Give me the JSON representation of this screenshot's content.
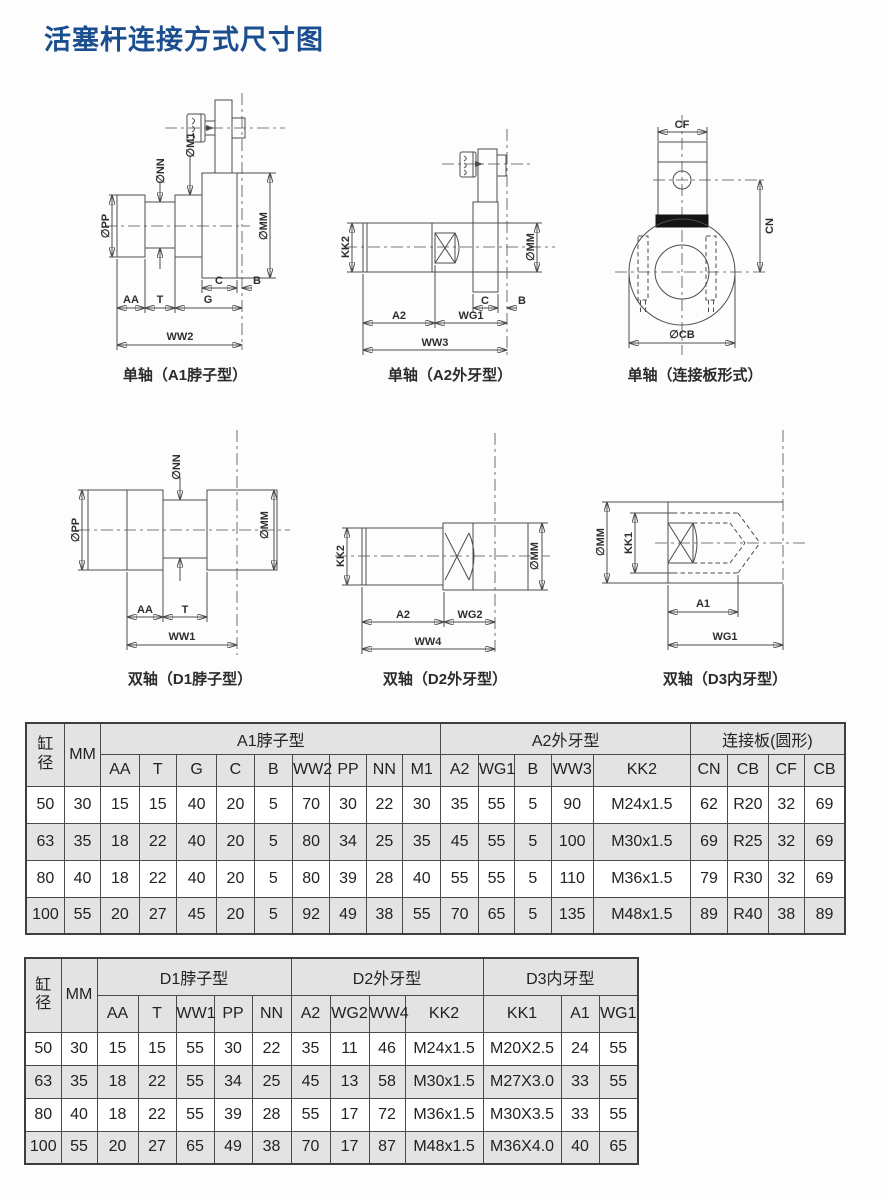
{
  "page": {
    "title": "活塞杆连接方式尺寸图"
  },
  "colors": {
    "title": "#1b4e8e",
    "stripe": "#e3e3e3",
    "line": "#4d4d4d"
  },
  "diagrams": {
    "a1": {
      "caption": "单轴（A1脖子型）",
      "pp": "∅PP",
      "nn": "∅NN",
      "m1": "∅M1",
      "mm": "∅MM",
      "c": "C",
      "b": "B",
      "aa": "AA",
      "t": "T",
      "g": "G",
      "ww2": "WW2"
    },
    "a2": {
      "caption": "单轴（A2外牙型）",
      "kk2": "KK2",
      "mm": "∅MM",
      "c": "C",
      "b": "B",
      "a2": "A2",
      "wg1": "WG1",
      "ww3": "WW3"
    },
    "plate": {
      "caption": "单轴（连接板形式）",
      "cf": "CF",
      "cn": "CN",
      "cb": "∅CB"
    },
    "d1": {
      "caption": "双轴（D1脖子型）",
      "pp": "∅PP",
      "nn": "∅NN",
      "mm": "∅MM",
      "aa": "AA",
      "t": "T",
      "ww1": "WW1"
    },
    "d2": {
      "caption": "双轴（D2外牙型）",
      "kk2": "KK2",
      "mm": "∅MM",
      "a2": "A2",
      "wg2": "WG2",
      "ww4": "WW4"
    },
    "d3": {
      "caption": "双轴（D3内牙型）",
      "mm": "∅MM",
      "kk1": "KK1",
      "a1": "A1",
      "wg1": "WG1"
    }
  },
  "table_single": {
    "corner": "缸径",
    "bore_col": "MM",
    "groups": [
      {
        "label": "A1脖子型",
        "span": 9
      },
      {
        "label": "A2外牙型",
        "span": 5
      },
      {
        "label": "连接板(圆形)",
        "span": 4
      }
    ],
    "columns": [
      "AA",
      "T",
      "G",
      "C",
      "B",
      "WW2",
      "PP",
      "NN",
      "M1",
      "A2",
      "WG1",
      "B",
      "WW3",
      "KK2",
      "CN",
      "CB",
      "CF",
      "CB"
    ],
    "rows": [
      [
        "50",
        "30",
        "15",
        "15",
        "40",
        "20",
        "5",
        "70",
        "30",
        "22",
        "30",
        "35",
        "55",
        "5",
        "90",
        "M24x1.5",
        "62",
        "R20",
        "32",
        "69"
      ],
      [
        "63",
        "35",
        "18",
        "22",
        "40",
        "20",
        "5",
        "80",
        "34",
        "25",
        "35",
        "45",
        "55",
        "5",
        "100",
        "M30x1.5",
        "69",
        "R25",
        "32",
        "69"
      ],
      [
        "80",
        "40",
        "18",
        "22",
        "40",
        "20",
        "5",
        "80",
        "39",
        "28",
        "40",
        "55",
        "55",
        "5",
        "110",
        "M36x1.5",
        "79",
        "R30",
        "32",
        "69"
      ],
      [
        "100",
        "55",
        "20",
        "27",
        "45",
        "20",
        "5",
        "92",
        "49",
        "38",
        "55",
        "70",
        "65",
        "5",
        "135",
        "M48x1.5",
        "89",
        "R40",
        "38",
        "89"
      ]
    ]
  },
  "table_double": {
    "corner": "缸径",
    "bore_col": "MM",
    "groups": [
      {
        "label": "D1脖子型",
        "span": 5
      },
      {
        "label": "D2外牙型",
        "span": 4
      },
      {
        "label": "D3内牙型",
        "span": 3
      }
    ],
    "columns": [
      "AA",
      "T",
      "WW1",
      "PP",
      "NN",
      "A2",
      "WG2",
      "WW4",
      "KK2",
      "KK1",
      "A1",
      "WG1"
    ],
    "rows": [
      [
        "50",
        "30",
        "15",
        "15",
        "55",
        "30",
        "22",
        "35",
        "11",
        "46",
        "M24x1.5",
        "M20X2.5",
        "24",
        "55"
      ],
      [
        "63",
        "35",
        "18",
        "22",
        "55",
        "34",
        "25",
        "45",
        "13",
        "58",
        "M30x1.5",
        "M27X3.0",
        "33",
        "55"
      ],
      [
        "80",
        "40",
        "18",
        "22",
        "55",
        "39",
        "28",
        "55",
        "17",
        "72",
        "M36x1.5",
        "M30X3.5",
        "33",
        "55"
      ],
      [
        "100",
        "55",
        "20",
        "27",
        "65",
        "49",
        "38",
        "70",
        "17",
        "87",
        "M48x1.5",
        "M36X4.0",
        "40",
        "65"
      ]
    ]
  }
}
